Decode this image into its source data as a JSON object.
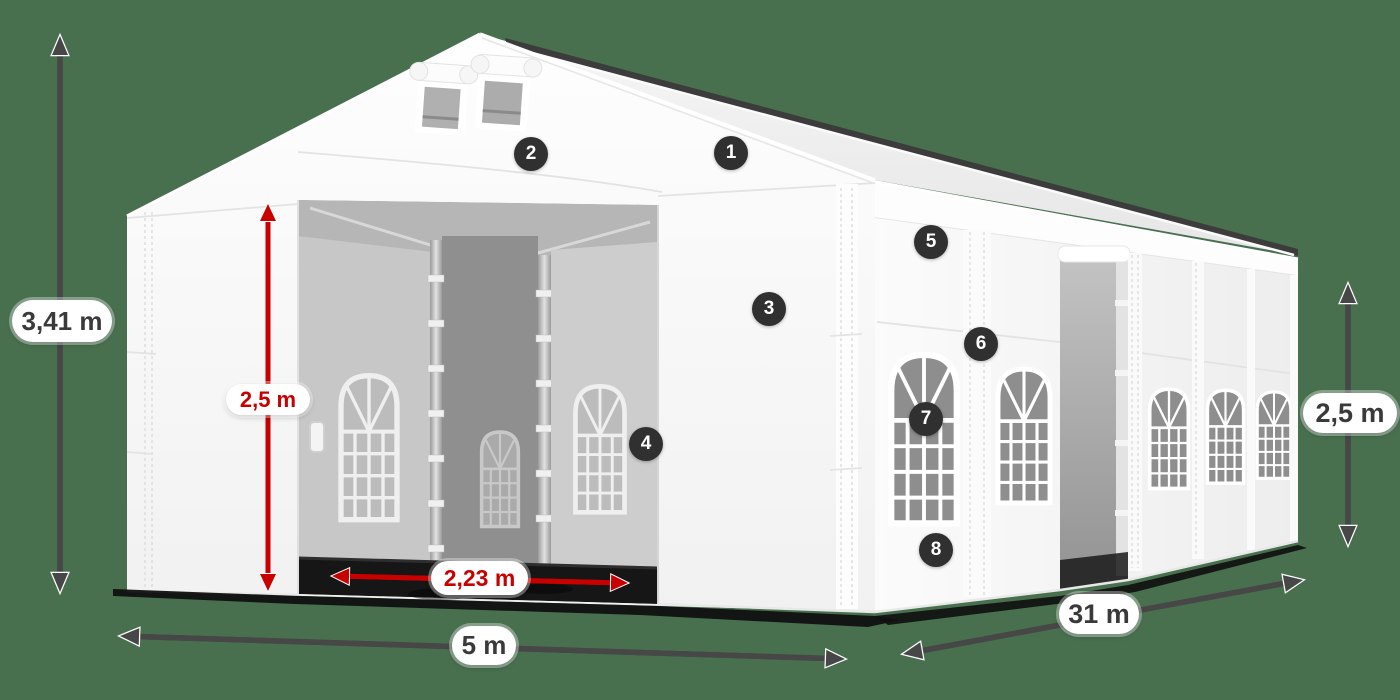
{
  "scene": {
    "background_color": "#48704F",
    "subject": "White tent 3D render with dimension annotations and numbered part hotspots"
  },
  "dimensions": {
    "total_height": {
      "text": "3,41 m",
      "style": "gray",
      "color": "#3A3A3A",
      "arrow_color": "#474747"
    },
    "door_height": {
      "text": "2,5 m",
      "style": "red",
      "color": "#C80000",
      "arrow_color": "#C80000"
    },
    "door_width": {
      "text": "2,23 m",
      "style": "red",
      "color": "#C80000",
      "arrow_color": "#C80000"
    },
    "front_width": {
      "text": "5 m",
      "style": "gray",
      "color": "#3A3A3A",
      "arrow_color": "#474747"
    },
    "length": {
      "text": "31 m",
      "style": "gray",
      "color": "#3A3A3A",
      "arrow_color": "#474747"
    },
    "side_height": {
      "text": "2,5 m",
      "style": "gray",
      "color": "#3A3A3A",
      "arrow_color": "#474747"
    }
  },
  "hotspots": {
    "badge_color": "#303030",
    "items": [
      {
        "number": "1"
      },
      {
        "number": "2"
      },
      {
        "number": "3"
      },
      {
        "number": "4"
      },
      {
        "number": "5"
      },
      {
        "number": "6"
      },
      {
        "number": "7"
      },
      {
        "number": "8"
      }
    ]
  }
}
